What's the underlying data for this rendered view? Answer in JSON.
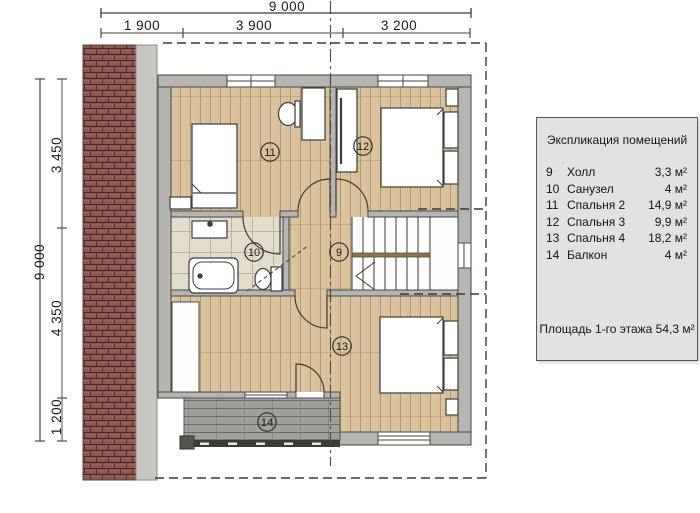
{
  "dimensions": {
    "top": {
      "total": "9 000",
      "segments": [
        "1 900",
        "3 900",
        "3 200"
      ]
    },
    "left": {
      "total": "9 000",
      "segments": [
        "3 450",
        "4 350",
        "1 200"
      ]
    }
  },
  "markers": [
    {
      "room": "bedroom-2",
      "label": "11"
    },
    {
      "room": "bedroom-3",
      "label": "12"
    },
    {
      "room": "bathroom",
      "label": "10"
    },
    {
      "room": "hall",
      "label": "9"
    },
    {
      "room": "bedroom-4",
      "label": "13"
    },
    {
      "room": "balcony",
      "label": "14"
    }
  ],
  "legend": {
    "title": "Экспликация помещений",
    "rows": [
      {
        "num": "9",
        "name": "Холл",
        "area": "3,3 м²"
      },
      {
        "num": "10",
        "name": "Санузел",
        "area": "4 м²"
      },
      {
        "num": "11",
        "name": "Спальня 2",
        "area": "14,9 м²"
      },
      {
        "num": "12",
        "name": "Спальня 3",
        "area": "9,9 м²"
      },
      {
        "num": "13",
        "name": "Спальня 4",
        "area": "18,2 м²"
      },
      {
        "num": "14",
        "name": "Балкон",
        "area": "4 м²"
      }
    ],
    "footer": "Площадь 1-го этажа 54,3 м²"
  },
  "colors": {
    "wall_fill": "#b6b5b2",
    "wall_line": "#474641",
    "wood_floor": "#d9c19b",
    "bath_tile": "#e3dccd",
    "roof_tile": "#8d5950",
    "deck": "#a0a09c",
    "legend_bg": "#e3e2e0",
    "dim_line": "#8c8378"
  }
}
